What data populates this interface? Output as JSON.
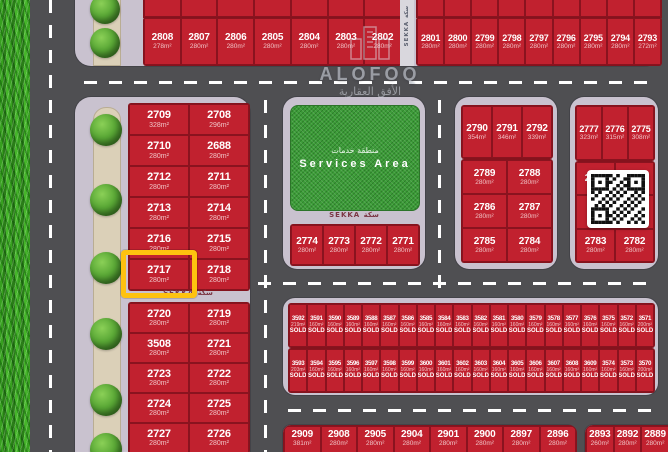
{
  "meta": {
    "road_label": "SEKKA سكة",
    "highlighted_plot": "2717",
    "colors": {
      "plot_red": "#c1212f",
      "block_lavender": "#c9c2cf",
      "road_gray": "#4f4f52",
      "highlight_yellow": "#fec20f",
      "services_green": "#3c9c38"
    }
  },
  "watermark": {
    "brand": "ALOFOQ",
    "brand_ar": "الأفق العقارية"
  },
  "services": {
    "title_en": "Services Area",
    "title_ar": "منطقة خدمات"
  },
  "top_row_left": [
    {
      "n": "2808",
      "a": "278m²"
    },
    {
      "n": "2807",
      "a": "280m²"
    },
    {
      "n": "2806",
      "a": "280m²"
    },
    {
      "n": "2805",
      "a": "280m²"
    },
    {
      "n": "2804",
      "a": "280m²"
    },
    {
      "n": "2803",
      "a": "280m²"
    },
    {
      "n": "2802",
      "a": "280m²"
    }
  ],
  "top_row_right": [
    {
      "n": "2801",
      "a": "280m²"
    },
    {
      "n": "2800",
      "a": "280m²"
    },
    {
      "n": "2799",
      "a": "280m²"
    },
    {
      "n": "2798",
      "a": "280m²"
    },
    {
      "n": "2797",
      "a": "280m²"
    },
    {
      "n": "2796",
      "a": "280m²"
    },
    {
      "n": "2795",
      "a": "280m²"
    },
    {
      "n": "2794",
      "a": "280m²"
    },
    {
      "n": "2793",
      "a": "272m²"
    }
  ],
  "left_upper": [
    {
      "n": "2709",
      "a": "328m²"
    },
    {
      "n": "2708",
      "a": "296m²"
    },
    {
      "n": "2710",
      "a": "280m²"
    },
    {
      "n": "2688",
      "a": "280m²"
    },
    {
      "n": "2712",
      "a": "280m²"
    },
    {
      "n": "2711",
      "a": "280m²"
    },
    {
      "n": "2713",
      "a": "280m²"
    },
    {
      "n": "2714",
      "a": "280m²"
    },
    {
      "n": "2716",
      "a": "280m²"
    },
    {
      "n": "2715",
      "a": "280m²"
    },
    {
      "n": "2717",
      "a": "280m²"
    },
    {
      "n": "2718",
      "a": "280m²"
    }
  ],
  "left_lower": [
    {
      "n": "2720",
      "a": "280m²"
    },
    {
      "n": "2719",
      "a": "280m²"
    },
    {
      "n": "3508",
      "a": "280m²"
    },
    {
      "n": "2721",
      "a": "280m²"
    },
    {
      "n": "2723",
      "a": "280m²"
    },
    {
      "n": "2722",
      "a": "280m²"
    },
    {
      "n": "2724",
      "a": "280m²"
    },
    {
      "n": "2725",
      "a": "280m²"
    },
    {
      "n": "2727",
      "a": "280m²"
    },
    {
      "n": "2726",
      "a": "280m²"
    }
  ],
  "mid_row": [
    {
      "n": "2774",
      "a": "280m²"
    },
    {
      "n": "2773",
      "a": "280m²"
    },
    {
      "n": "2772",
      "a": "280m²"
    },
    {
      "n": "2771",
      "a": "280m²"
    }
  ],
  "rmid_row1": [
    {
      "n": "2790",
      "a": "354m²"
    },
    {
      "n": "2791",
      "a": "346m²"
    },
    {
      "n": "2792",
      "a": "339m²"
    }
  ],
  "rmid_rows": [
    {
      "n": "2789",
      "a": "280m²"
    },
    {
      "n": "2788",
      "a": "280m²"
    },
    {
      "n": "2786",
      "a": "280m²"
    },
    {
      "n": "2787",
      "a": "280m²"
    },
    {
      "n": "2785",
      "a": "280m²"
    },
    {
      "n": "2784",
      "a": "280m²"
    }
  ],
  "far_row1": [
    {
      "n": "2777",
      "a": "323m²"
    },
    {
      "n": "2776",
      "a": "315m²"
    },
    {
      "n": "2775",
      "a": "308m²"
    }
  ],
  "far_rows": [
    {
      "n": "2779",
      "a": ""
    },
    {
      "n": "2778",
      "a": "280m²"
    },
    {
      "n": "",
      "a": ""
    },
    {
      "n": "2781",
      "a": "280m²"
    },
    {
      "n": "2783",
      "a": "280m²"
    },
    {
      "n": "2782",
      "a": "280m²"
    }
  ],
  "sold_row1": [
    {
      "n": "3592",
      "a": "219m²",
      "s": "SOLD"
    },
    {
      "n": "3591",
      "a": "160m²",
      "s": "SOLD"
    },
    {
      "n": "3590",
      "a": "160m²",
      "s": "SOLD"
    },
    {
      "n": "3589",
      "a": "160m²",
      "s": "SOLD"
    },
    {
      "n": "3588",
      "a": "160m²",
      "s": "SOLD"
    },
    {
      "n": "3587",
      "a": "160m²",
      "s": "SOLD"
    },
    {
      "n": "3586",
      "a": "160m²",
      "s": "SOLD"
    },
    {
      "n": "3585",
      "a": "160m²",
      "s": "SOLD"
    },
    {
      "n": "3584",
      "a": "160m²",
      "s": "SOLD"
    },
    {
      "n": "3583",
      "a": "160m²",
      "s": "SOLD"
    },
    {
      "n": "3582",
      "a": "160m²",
      "s": "SOLD"
    },
    {
      "n": "3581",
      "a": "160m²",
      "s": "SOLD"
    },
    {
      "n": "3580",
      "a": "160m²",
      "s": "SOLD"
    },
    {
      "n": "3579",
      "a": "160m²",
      "s": "SOLD"
    },
    {
      "n": "3578",
      "a": "160m²",
      "s": "SOLD"
    },
    {
      "n": "3577",
      "a": "160m²",
      "s": "SOLD"
    },
    {
      "n": "3576",
      "a": "160m²",
      "s": "SOLD"
    },
    {
      "n": "3575",
      "a": "160m²",
      "s": "SOLD"
    },
    {
      "n": "3572",
      "a": "160m²",
      "s": "SOLD"
    },
    {
      "n": "3571",
      "a": "200m²",
      "s": "SOLD"
    }
  ],
  "sold_row2": [
    {
      "n": "3593",
      "a": "203m²",
      "s": "SOLD"
    },
    {
      "n": "3594",
      "a": "160m²",
      "s": "SOLD"
    },
    {
      "n": "3595",
      "a": "160m²",
      "s": "SOLD"
    },
    {
      "n": "3596",
      "a": "160m²",
      "s": "SOLD"
    },
    {
      "n": "3597",
      "a": "160m²",
      "s": "SOLD"
    },
    {
      "n": "3598",
      "a": "160m²",
      "s": "SOLD"
    },
    {
      "n": "3599",
      "a": "160m²",
      "s": "SOLD"
    },
    {
      "n": "3600",
      "a": "160m²",
      "s": "SOLD"
    },
    {
      "n": "3601",
      "a": "160m²",
      "s": "SOLD"
    },
    {
      "n": "3602",
      "a": "160m²",
      "s": "SOLD"
    },
    {
      "n": "3603",
      "a": "160m²",
      "s": "SOLD"
    },
    {
      "n": "3604",
      "a": "160m²",
      "s": "SOLD"
    },
    {
      "n": "3605",
      "a": "160m²",
      "s": "SOLD"
    },
    {
      "n": "3606",
      "a": "160m²",
      "s": "SOLD"
    },
    {
      "n": "3607",
      "a": "160m²",
      "s": "SOLD"
    },
    {
      "n": "3608",
      "a": "160m²",
      "s": "SOLD"
    },
    {
      "n": "3609",
      "a": "160m²",
      "s": "SOLD"
    },
    {
      "n": "3574",
      "a": "160m²",
      "s": "SOLD"
    },
    {
      "n": "3573",
      "a": "160m²",
      "s": "SOLD"
    },
    {
      "n": "3570",
      "a": "200m²",
      "s": "SOLD"
    }
  ],
  "bottom_left": [
    {
      "n": "2909",
      "a": "381m²"
    },
    {
      "n": "2908",
      "a": "280m²"
    },
    {
      "n": "2905",
      "a": "280m²"
    },
    {
      "n": "2904",
      "a": "280m²"
    },
    {
      "n": "2901",
      "a": "280m²"
    },
    {
      "n": "2900",
      "a": "280m²"
    },
    {
      "n": "2897",
      "a": "280m²"
    },
    {
      "n": "2896",
      "a": "280m²"
    }
  ],
  "bottom_right": [
    {
      "n": "2893",
      "a": "260m²"
    },
    {
      "n": "2892",
      "a": "280m²"
    },
    {
      "n": "2889",
      "a": "280m²"
    }
  ]
}
